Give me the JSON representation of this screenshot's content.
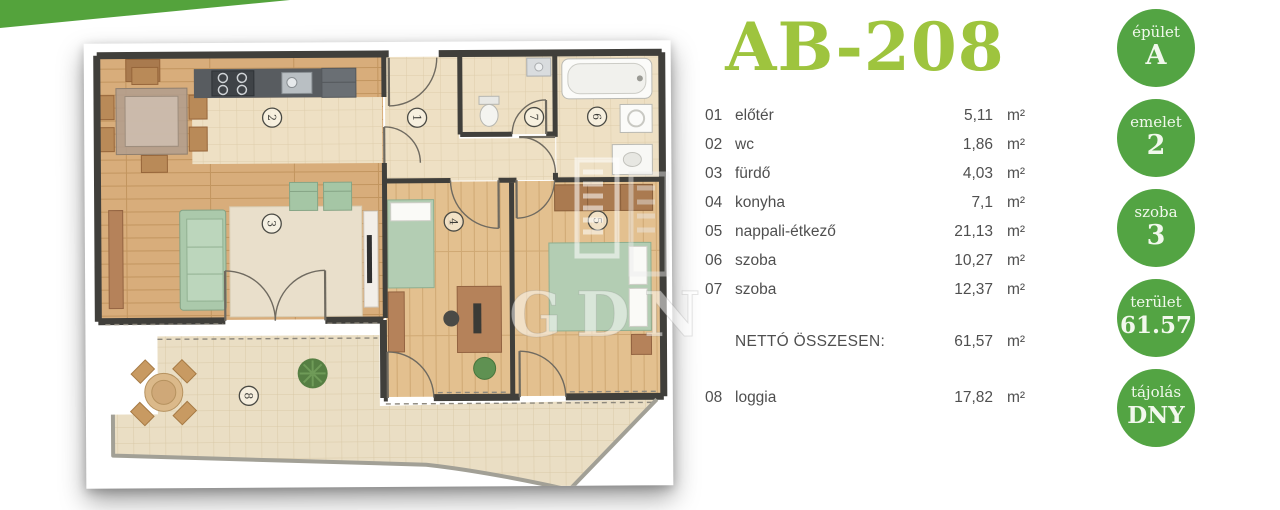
{
  "accent": {
    "wedge_color": "#54a33c",
    "badge_color": "#53a443",
    "title_color": "#9ec43e"
  },
  "title": "AB-208",
  "watermark": "GDN",
  "rooms": [
    {
      "num": "01",
      "name": "előtér",
      "area": "5,11",
      "unit": "m²"
    },
    {
      "num": "02",
      "name": "wc",
      "area": "1,86",
      "unit": "m²"
    },
    {
      "num": "03",
      "name": "fürdő",
      "area": "4,03",
      "unit": "m²"
    },
    {
      "num": "04",
      "name": "konyha",
      "area": "7,1",
      "unit": "m²"
    },
    {
      "num": "05",
      "name": "nappali-étkező",
      "area": "21,13",
      "unit": "m²"
    },
    {
      "num": "06",
      "name": "szoba",
      "area": "10,27",
      "unit": "m²"
    },
    {
      "num": "07",
      "name": "szoba",
      "area": "12,37",
      "unit": "m²"
    }
  ],
  "total": {
    "label": "NETTÓ ÖSSZESEN:",
    "value": "61,57",
    "unit": "m²"
  },
  "extra": {
    "num": "08",
    "name": "loggia",
    "area": "17,82",
    "unit": "m²"
  },
  "badges": [
    {
      "label": "épület",
      "value": "A"
    },
    {
      "label": "emelet",
      "value": "2"
    },
    {
      "label": "szoba",
      "value": "3"
    },
    {
      "label": "terület",
      "value": "61.57"
    },
    {
      "label": "tájolás",
      "value": "DNY"
    }
  ],
  "floorplan": {
    "labels": [
      "1",
      "2",
      "3",
      "4",
      "5",
      "6",
      "7",
      "8"
    ]
  }
}
